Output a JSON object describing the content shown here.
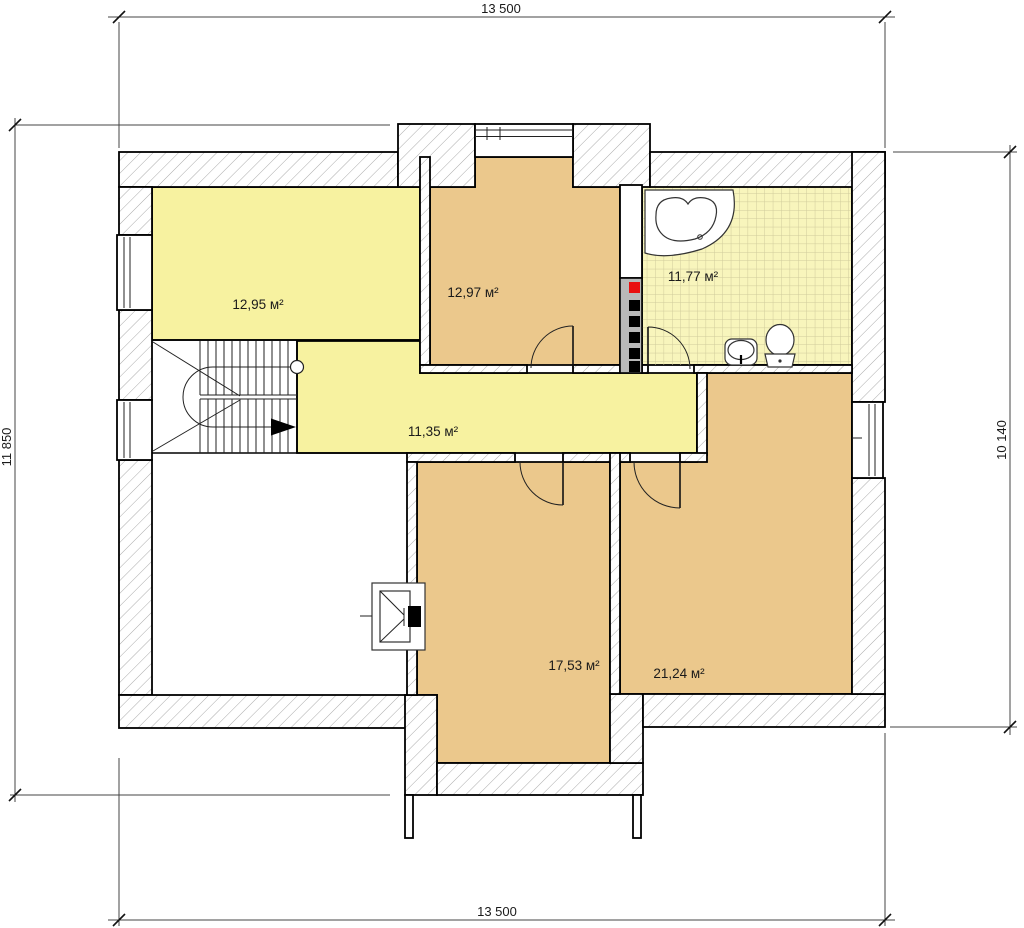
{
  "plan": {
    "type": "floor-plan",
    "dimensions": {
      "top": "13 500",
      "bottom": "13 500",
      "left": "11 850",
      "right": "10 140"
    },
    "rooms": {
      "room_top_left": {
        "area": "12,95 м²"
      },
      "room_top_middle": {
        "area": "12,97 м²"
      },
      "bathroom": {
        "area": "11,77 м²"
      },
      "hallway": {
        "area": "11,35 м²"
      },
      "room_bottom_middle": {
        "area": "17,53 м²"
      },
      "room_bottom_right": {
        "area": "21,24 м²"
      }
    },
    "fixtures": {
      "bathtub": "corner-bathtub",
      "sink": "washbasin",
      "toilet": "toilet",
      "stairs": "u-turn-staircase",
      "chimney": "flue-stack",
      "roof_hatch": "roof-window"
    },
    "colors": {
      "room_yellow": "#F7F2A0",
      "room_tan": "#EBC88C",
      "bath_tile": "#F8F5BC",
      "tile_grid": "#CFCB9B",
      "wall_hatch": "#ABABAB",
      "wall_outline": "#000000",
      "chimney_gray": "#B9B9B9",
      "flue_red": "#E90F0F"
    }
  }
}
